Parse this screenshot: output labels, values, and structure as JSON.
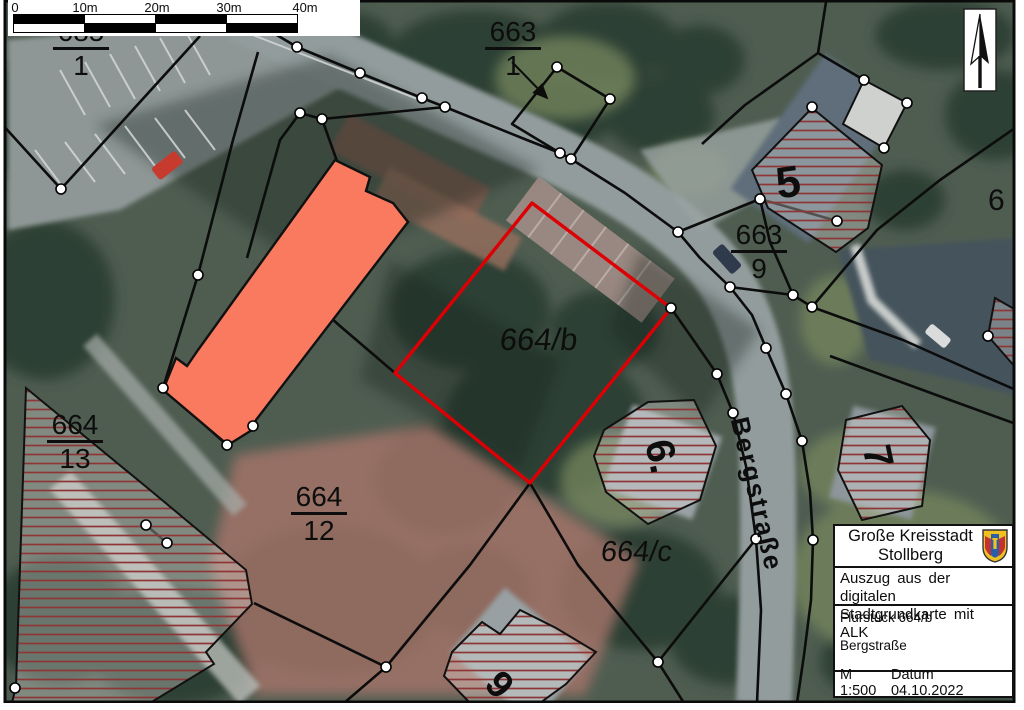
{
  "colors": {
    "parcel-red": "#dc0005",
    "building-orange": "#f97a5e",
    "hatch-red": "#8e3535",
    "boundary-black": "#0c0c0c",
    "crest-gold": "#f0c020",
    "crest-red": "#c43034",
    "crest-blue": "#2a5fa8"
  },
  "scale_bar": {
    "labels": [
      "0",
      "10m",
      "20m",
      "30m",
      "40m"
    ]
  },
  "north_arrow": {
    "icon": "north-arrow-icon"
  },
  "parcels": {
    "p685_1": {
      "num": "685",
      "den": "1"
    },
    "p663_1": {
      "num": "663",
      "den": "1"
    },
    "p663_9": {
      "num": "663",
      "den": "9"
    },
    "p664_13": {
      "num": "664",
      "den": "13"
    },
    "p664_12": {
      "num": "664",
      "den": "12"
    },
    "p664_b": {
      "label": "664/b"
    },
    "p664_c": {
      "label": "664/c"
    },
    "edge_number": "6"
  },
  "houses": {
    "h5": "5",
    "h6": "6.",
    "h7": "7",
    "h9": "9"
  },
  "street": {
    "name": "Bergstraße"
  },
  "info_box": {
    "municipality_line1": "Große Kreisstadt",
    "municipality_line2": "Stollberg",
    "subtitle_line1": "Auszug aus der digitalen",
    "subtitle_line2": "Stadtgrundkarte mit ALK",
    "parcel_label": "Flurstück 664/b",
    "street_label": "Bergstraße",
    "scale_text": "M 1:500",
    "date_text": "Datum 04.10.2022",
    "crest_icon": "stollberg-crest-icon"
  }
}
